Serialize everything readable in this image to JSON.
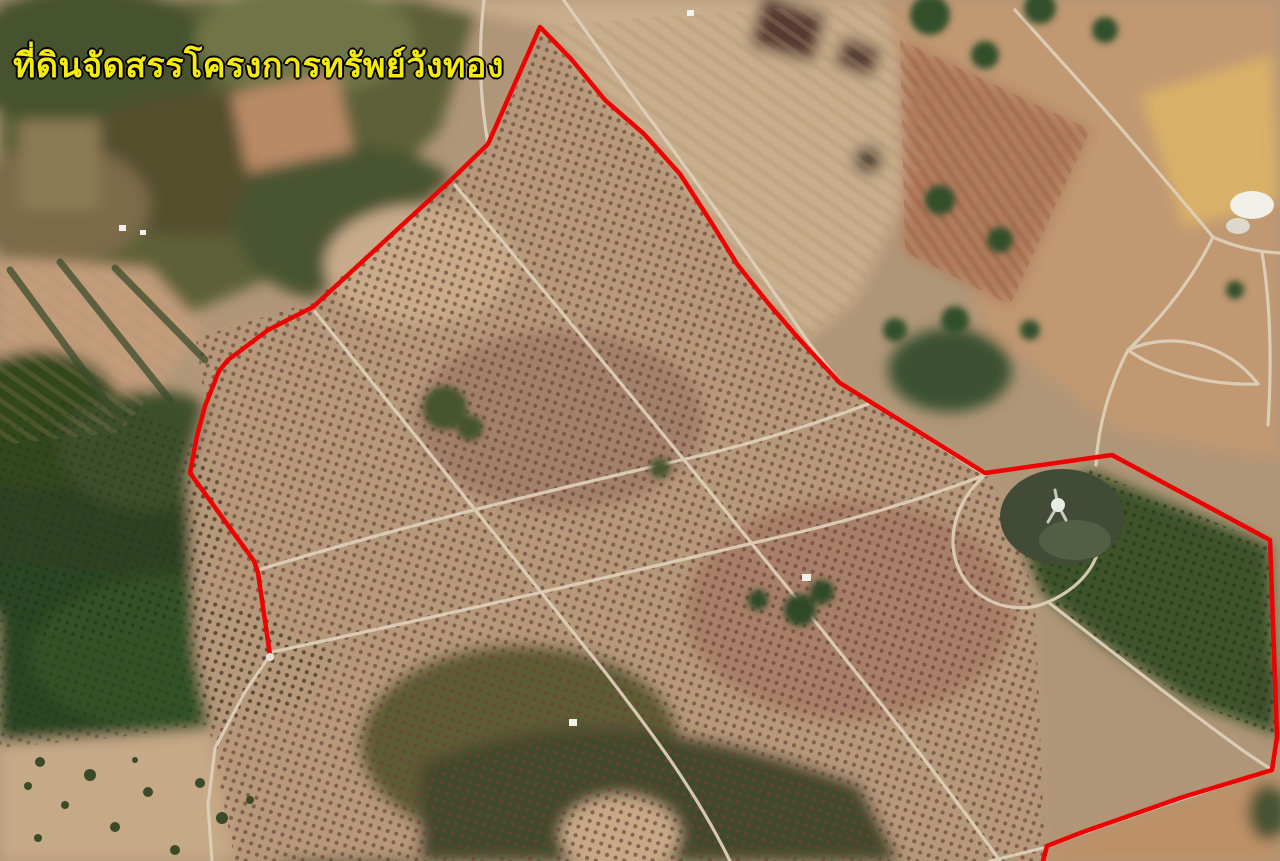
{
  "page": {
    "width": 1280,
    "height": 861
  },
  "annotation": {
    "title": "ที่ดินจัดสรรโครงการทรัพย์วังทอง",
    "title_color": "#f6ec00",
    "title_outline_color": "#000000"
  },
  "map": {
    "type": "satellite-aerial-photo",
    "description": "Aerial photograph of allocated land (Sap Wangthong project): orchard plots in a dotted grid, light dirt roads, forest patches, open fields and a pond, with a red surveyed boundary line",
    "boundary": {
      "color": "#ee0000",
      "stroke_width": 4.5,
      "points": "270,655 258,573 254,561 190,473 197,436 205,406 219,371 228,360 268,330 313,307 450,181 488,144 540,27 572,60 605,100 644,134 680,174 711,222 737,264 768,303 800,340 840,383 985,473 1112,455 1270,540 1277,737 1272,770 1183,797 1083,832 1047,846 1043,861"
    },
    "features": {
      "orchard_dot_color": "#6a4237",
      "green_orchard_color": "#3c5229",
      "forest_color": "#2b4421",
      "field_color": "#c6a987",
      "gold_field_color": "#d9b168",
      "road_color": "#decfb8",
      "pond_color": "#414b36",
      "building_color": "#f0efe8"
    }
  }
}
